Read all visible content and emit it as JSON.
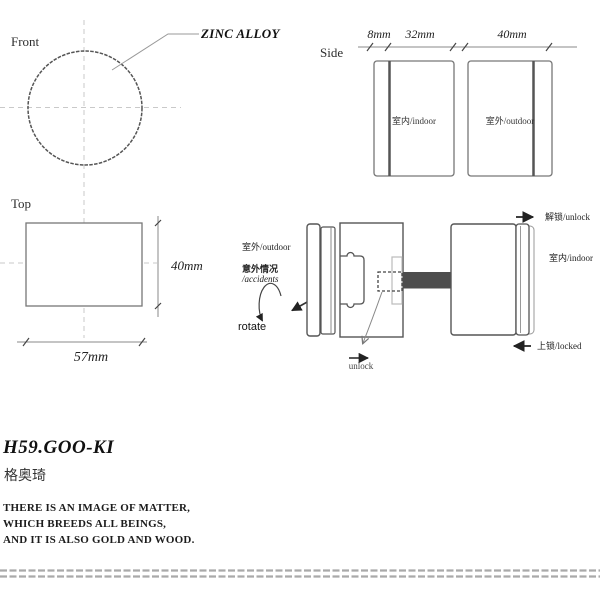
{
  "front_view": {
    "label": "Front",
    "callout": "ZINC ALLOY"
  },
  "side_view": {
    "label": "Side",
    "dim_labels": [
      "8mm",
      "32mm",
      "40mm"
    ],
    "indoor_knob_label": "室内/indoor",
    "outdoor_knob_label": "室外/outdoor"
  },
  "top_view": {
    "label": "Top",
    "height_dim": "40mm",
    "width_dim": "57mm"
  },
  "operation_view": {
    "outdoor_label": "室外/outdoor",
    "accident_zh": "意外情况",
    "accident_en": "/accidents",
    "rotate_label": "rotate",
    "unlock_action": "unlock",
    "unlock_state": "解锁/unlock",
    "indoor_label": "室内/indoor",
    "locked_state": "上锁/locked"
  },
  "footer": {
    "model": "H59.GOO-KI",
    "brand_cn": "格奥琦",
    "tagline": [
      "THERE IS AN IMAGE OF MATTER,",
      "WHICH BREEDS ALL BEINGS,",
      "AND IT IS ALSO GOLD AND WOOD."
    ]
  },
  "colors": {
    "outline": "#6b6b6b",
    "dark_outline": "#555555",
    "centerline": "#c9c9c9",
    "arrow": "#222222",
    "spindle_fill": "#4d4d4d",
    "slot_outline": "#bbbbbb",
    "divider": "#a9a9a9"
  }
}
